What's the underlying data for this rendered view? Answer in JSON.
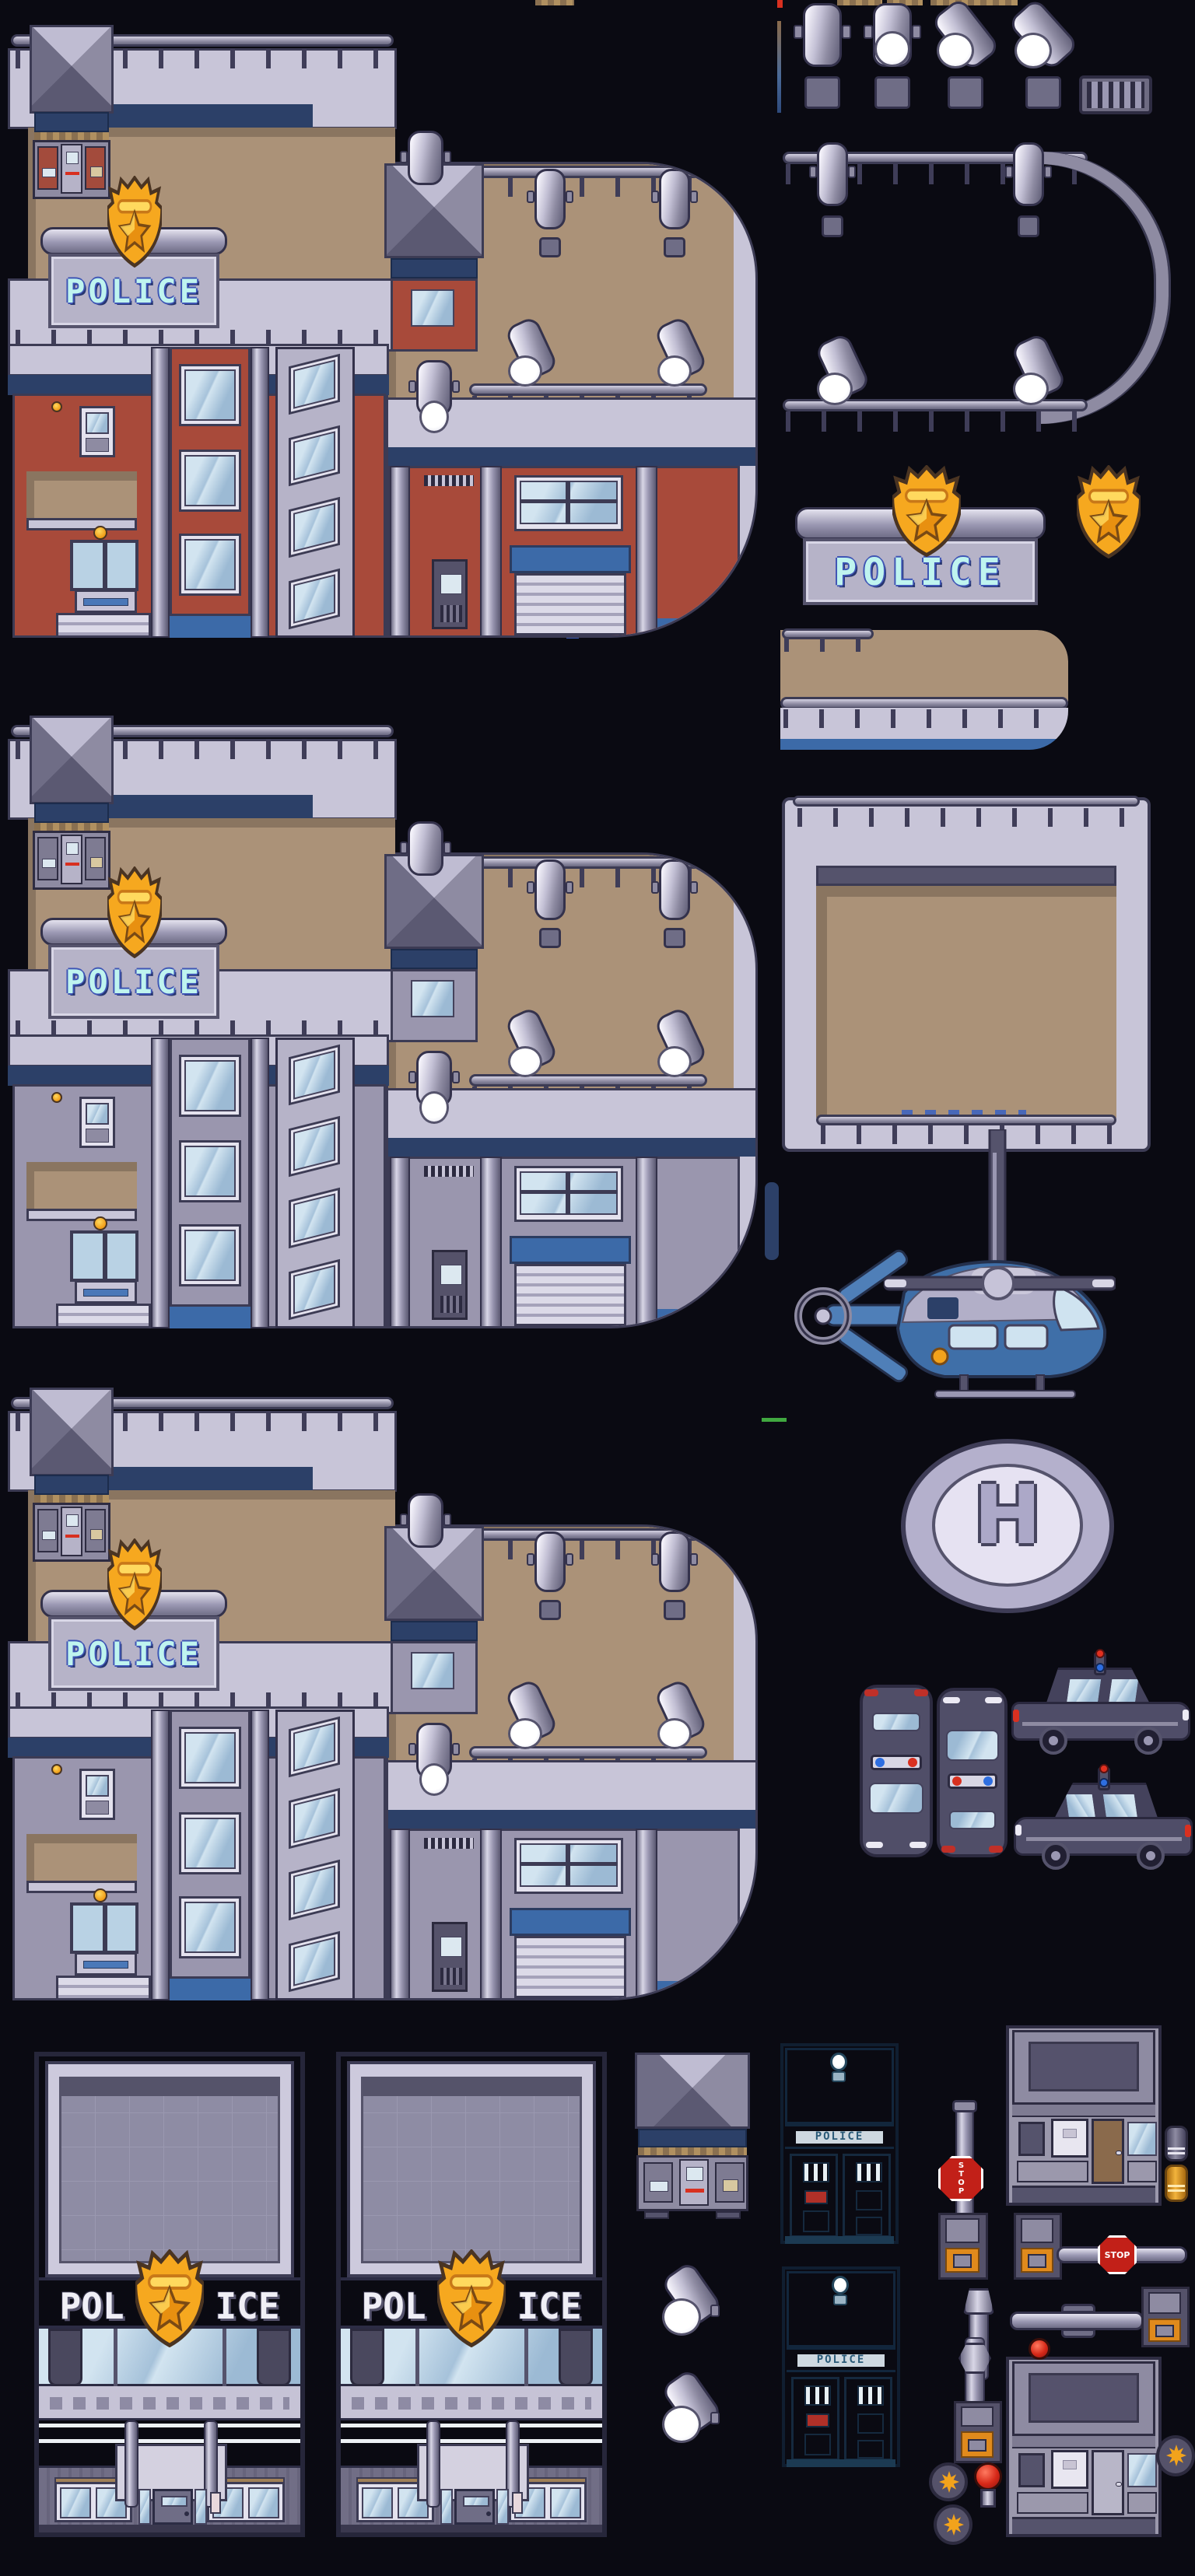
{
  "sheet": {
    "name": "police-station-pixel-tileset",
    "background": "#0a0a12",
    "description": "Sprite sheet of pixel-art police station buildings and props"
  },
  "texts": {
    "police": "POLICE",
    "pol": "POL",
    "ice": "ICE",
    "box_label": "POLICE",
    "helipad": "H",
    "stop": "STOP"
  },
  "colors": {
    "background": "#0a0a12",
    "wall_lavender": "#c8c5d8",
    "deck_tan": "#ab9278",
    "accent_red": "#a84a3a",
    "accent_gray": "#9a96ae",
    "navy_band": "#2c4068",
    "sign_text_cyan": "#bff4ef",
    "badge_gold": "#f6a81f",
    "base_blue": "#3c6aa8",
    "storefront_blue": "#3e7cab",
    "storefront_red": "#a8423a",
    "police_box_teal": "#4f93b0",
    "police_box_blue": "#3f86d8",
    "booth_orange": "#e08020",
    "booth_blue_stripe": "#2f7fe0",
    "stop_sign_red": "#c22018",
    "car_body": "#4d4b66",
    "helicopter_blue": "#3f6fa8",
    "helipad_ring": "#b4b0cc",
    "glass_blue": "#cfe2f0"
  },
  "sprites": [
    "police-station-red",
    "police-station-gray-1",
    "police-station-gray-2",
    "storefront-blue",
    "storefront-red",
    "spotlight-down-unlit",
    "spotlight-down-lit",
    "spotlight-tilt-lit-1",
    "spotlight-tilt-lit-2",
    "vent-grate",
    "railing-with-lamps",
    "police-sign-board",
    "police-badge",
    "roof-edge-piece",
    "roof-courtyard",
    "police-helicopter",
    "helipad",
    "police-car-top-down",
    "police-car-top-up",
    "police-car-side-right",
    "police-car-side-left",
    "rooftop-kiosk",
    "police-box-teal",
    "police-box-blue",
    "spotlight-small-1",
    "spotlight-small-2",
    "guard-booth-orange",
    "guard-booth-blue",
    "barrier-vertical-stop",
    "barrier-horizontal-stop",
    "barrier-arm",
    "barrier-base",
    "stacked-cylinders",
    "red-beacon",
    "badge-roundel-1",
    "badge-roundel-2",
    "badge-roundel-3"
  ]
}
